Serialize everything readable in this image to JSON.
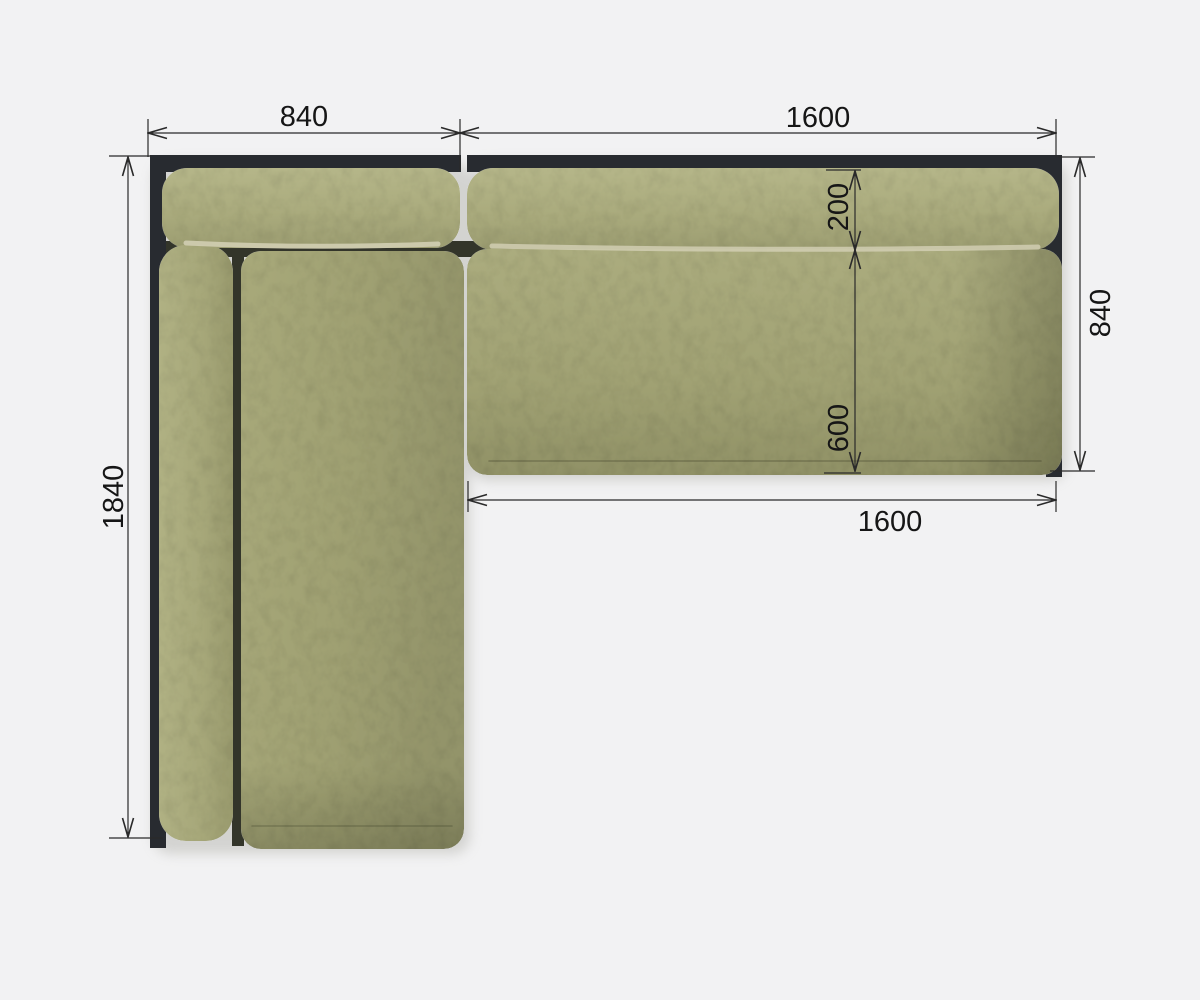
{
  "diagram": {
    "view": "sofa-top-view-dimension-drawing"
  },
  "dimensions": {
    "left_section_width": {
      "value": "840"
    },
    "right_section_width": {
      "value": "1600"
    },
    "left_section_depth": {
      "value": "1840"
    },
    "backrest_depth": {
      "value": "200"
    },
    "right_section_depth": {
      "value": "840"
    },
    "seat_depth": {
      "value": "600"
    },
    "seat_width": {
      "value": "1600"
    }
  },
  "colors": {
    "background": "#f2f2f3",
    "frame": "#282b30",
    "gap_shadow": "#33352a",
    "cushion_highlight": "#b5b689",
    "cushion_base": "#a4a577",
    "cushion_shadow": "#90915f",
    "piping_highlight": "#d5d1b6",
    "dimension_lines": "#2a2a2a",
    "dimension_text": "#161616"
  }
}
